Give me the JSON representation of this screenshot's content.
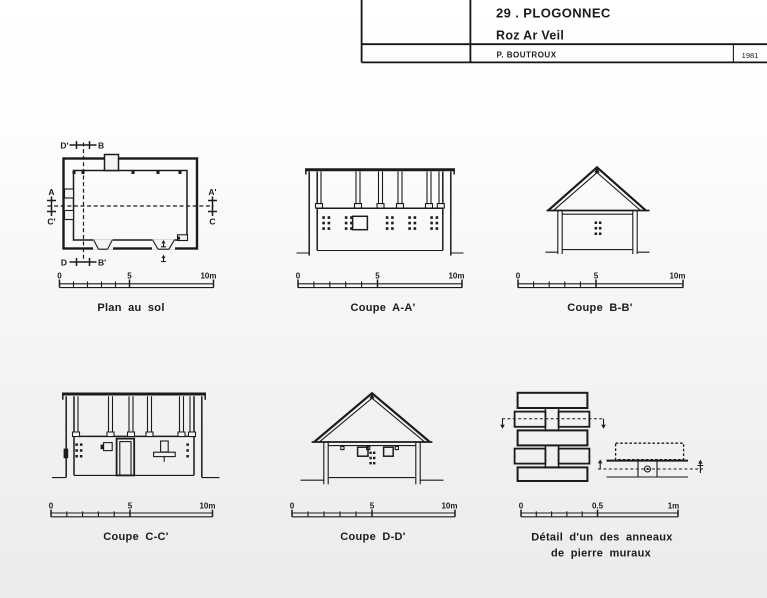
{
  "colors": {
    "ink": "#1b1b1b",
    "paper": "#f4f4f2"
  },
  "title_block": {
    "line1": "29 . PLOGONNEC",
    "line2": "Roz Ar Veil",
    "author": "P. BOUTROUX",
    "year": "1981"
  },
  "panels": {
    "plan": {
      "label": "Plan au sol",
      "scale": {
        "zero": "0",
        "mid": "5",
        "end": "10m"
      },
      "markers": {
        "top_left": "D'",
        "top_right": "B",
        "bottom_left": "D",
        "bottom_right": "B'",
        "left_top": "A",
        "left_bottom": "C'",
        "right_top": "A'",
        "right_bottom": "C"
      }
    },
    "coupe_aa": {
      "label": "Coupe A-A'",
      "scale": {
        "zero": "0",
        "mid": "5",
        "end": "10m"
      }
    },
    "coupe_bb": {
      "label": "Coupe B-B'",
      "scale": {
        "zero": "0",
        "mid": "5",
        "end": "10m"
      }
    },
    "coupe_cc": {
      "label": "Coupe C-C'",
      "scale": {
        "zero": "0",
        "mid": "5",
        "end": "10m"
      }
    },
    "coupe_dd": {
      "label": "Coupe D-D'",
      "scale": {
        "zero": "0",
        "mid": "5",
        "end": "10m"
      }
    },
    "detail": {
      "label_line1": "Détail d'un des anneaux",
      "label_line2": "de pierre muraux",
      "scale": {
        "zero": "0",
        "mid": "0.5",
        "end": "1m"
      }
    }
  }
}
